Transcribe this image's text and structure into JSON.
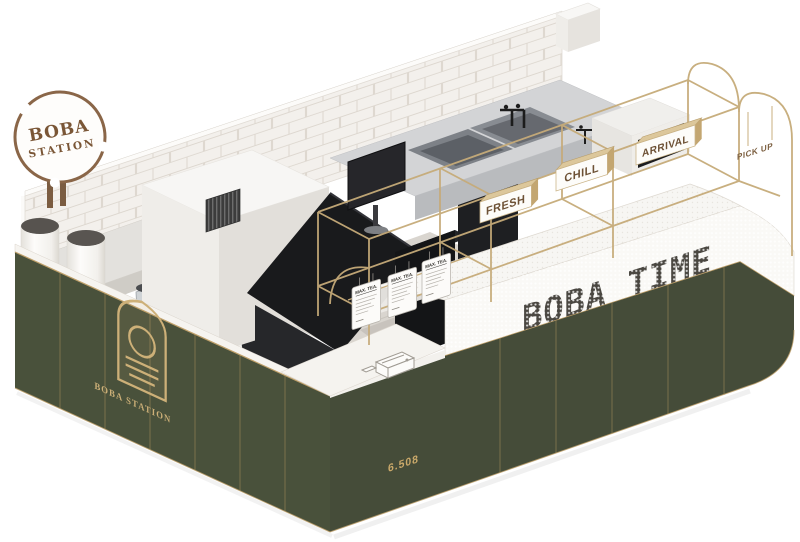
{
  "scene": {
    "title_sign": {
      "line1": "BOBA",
      "line2": "STATION"
    }
  },
  "signage": {
    "counter_text": "BOBA TIME",
    "hanging_signs": [
      {
        "label": "FRESH"
      },
      {
        "label": "CHILL"
      },
      {
        "label": "ARRIVAL"
      }
    ],
    "pickup_label": "PICK UP",
    "emblem_text": "BOBA STATION",
    "dimension_label": "6.508",
    "menu_cards": [
      {
        "title": "MAX. TEA."
      },
      {
        "title": "MAX. TEA."
      },
      {
        "title": "MAX. TEA."
      }
    ]
  },
  "colors": {
    "green_panel": "#49513b",
    "green_panel_right": "#454c39",
    "brass_gold": "#c6ab79",
    "sign_brown": "#7a5636",
    "tile_white": "#f3f0ec",
    "counter_white": "#faf9f6",
    "equipment_dark": "#191a1c"
  }
}
